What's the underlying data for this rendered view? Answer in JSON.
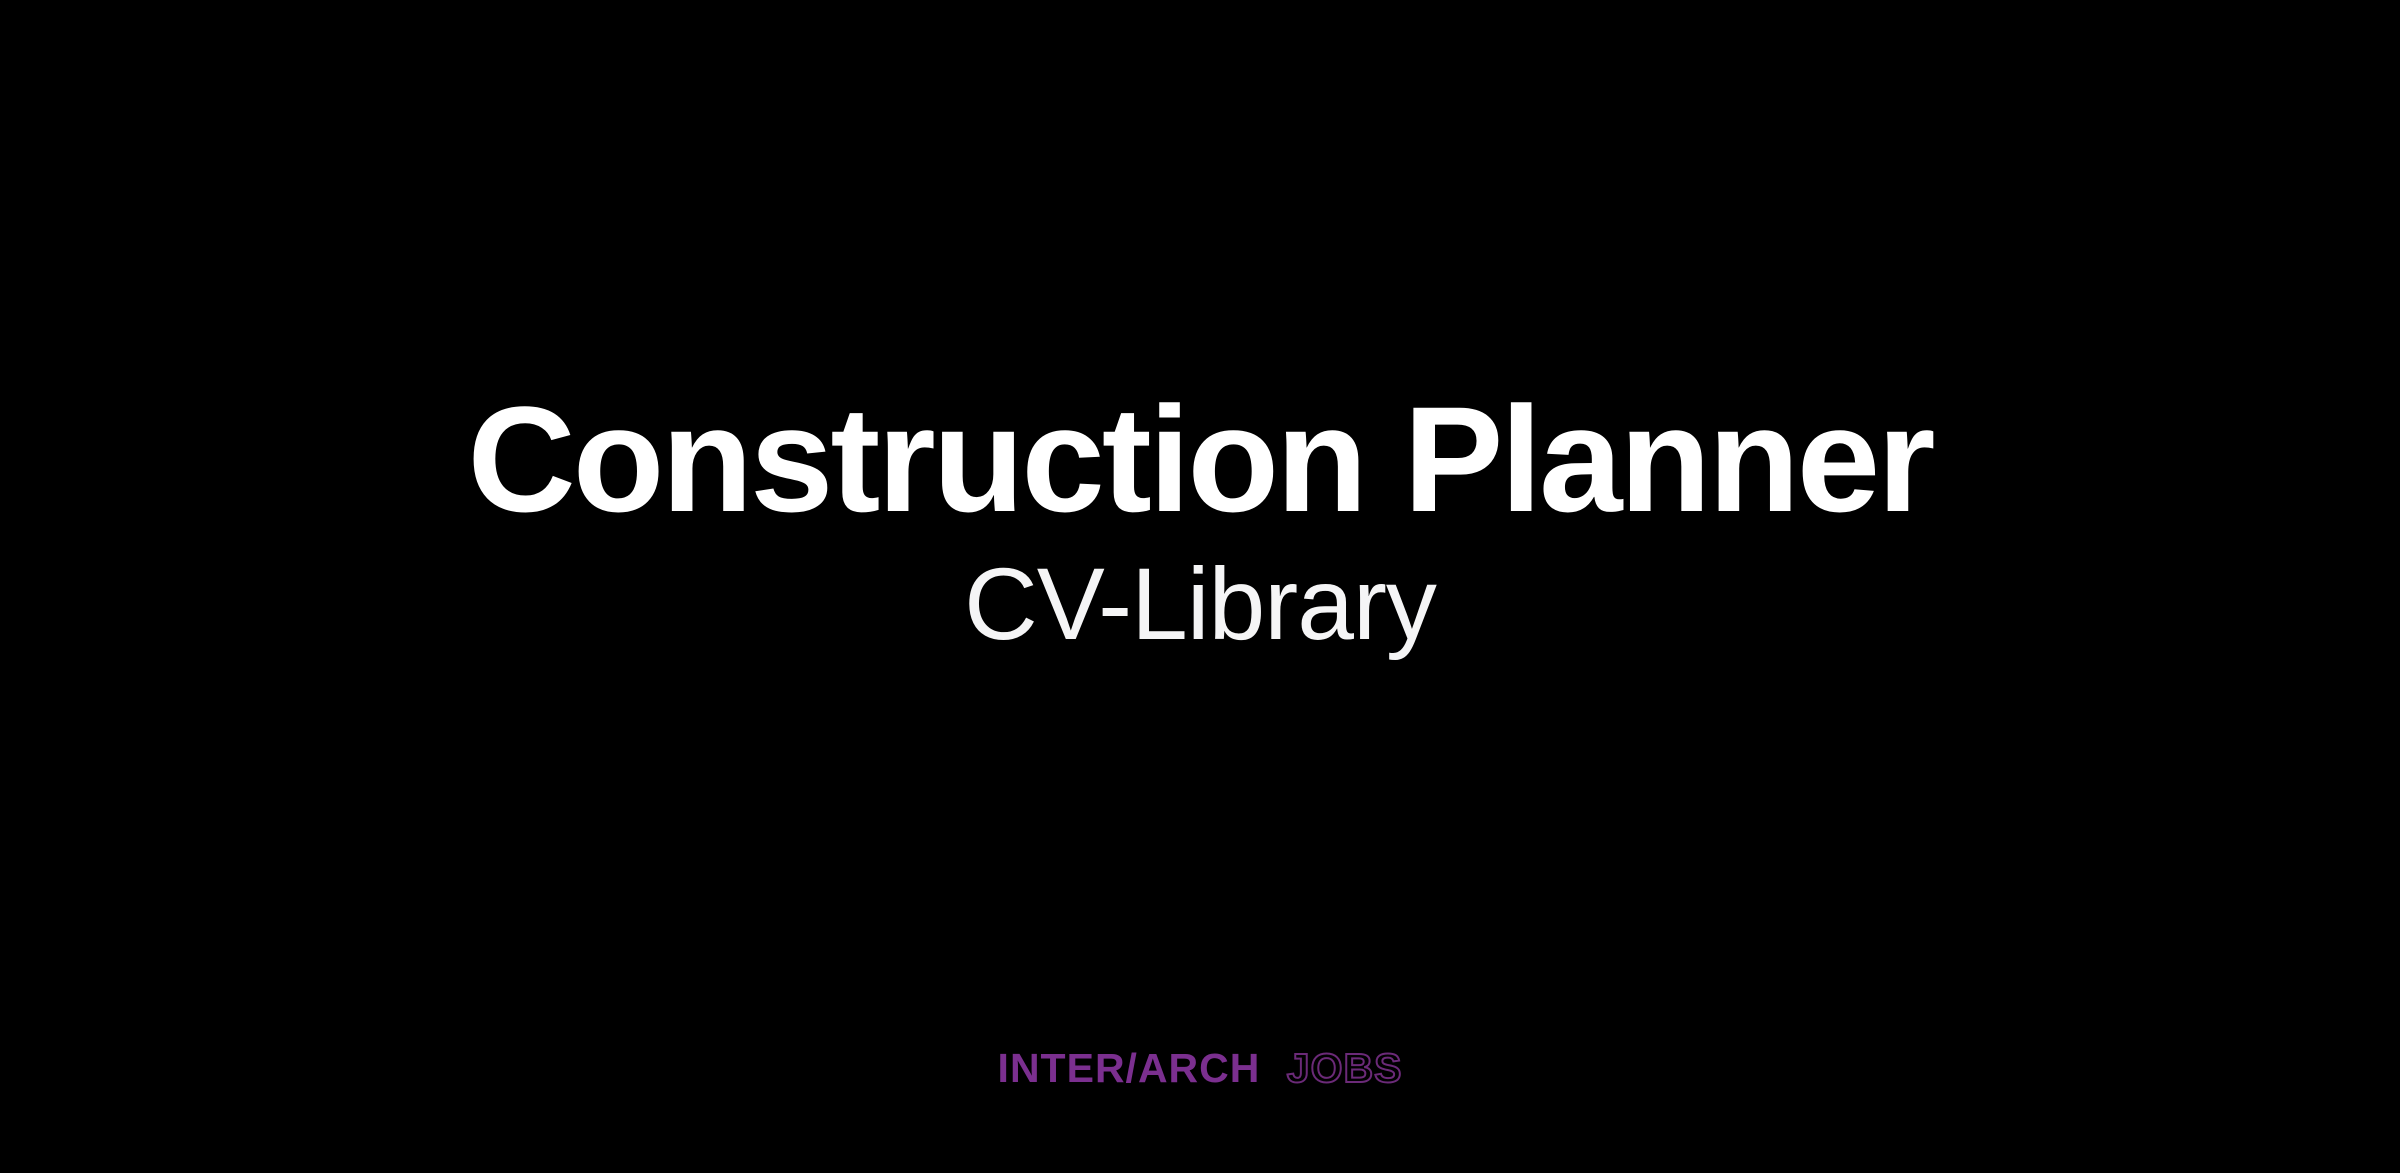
{
  "page": {
    "background_color": "#000000",
    "title": "Construction Planner",
    "subtitle": "CV-Library",
    "title_color": "#ffffff",
    "brand": {
      "primary": "INTER/ARCH",
      "secondary": "JOBS",
      "solid_color": "#7b2f8f",
      "outline_color": "#6b2a78"
    }
  }
}
